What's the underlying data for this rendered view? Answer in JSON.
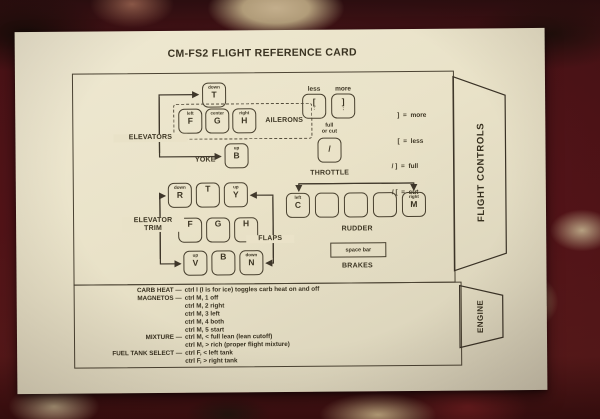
{
  "title": "CM-FS2 FLIGHT REFERENCE CARD",
  "flight_controls": {
    "tab_label": "FLIGHT CONTROLS",
    "yoke": {
      "label": "YOKE",
      "elevators_label": "ELEVATORS",
      "ailerons_label": "AILERONS",
      "key_down": {
        "hint": "down",
        "letter": "T"
      },
      "key_left": {
        "hint": "left",
        "letter": "F"
      },
      "key_center": {
        "hint": "center",
        "letter": "G"
      },
      "key_right": {
        "hint": "right",
        "letter": "H"
      },
      "key_up": {
        "hint": "up",
        "letter": "B"
      }
    },
    "trim": {
      "label_line1": "ELEVATOR",
      "label_line2": "TRIM",
      "flaps_label": "FLAPS",
      "keys": [
        {
          "hint": "down",
          "letter": "R"
        },
        {
          "hint": "",
          "letter": "T"
        },
        {
          "hint": "up",
          "letter": "Y"
        },
        {
          "hint": "",
          "letter": "F"
        },
        {
          "hint": "",
          "letter": "G"
        },
        {
          "hint": "",
          "letter": "H"
        },
        {
          "hint": "up",
          "letter": "V"
        },
        {
          "hint": "",
          "letter": "B"
        },
        {
          "hint": "down",
          "letter": "N"
        }
      ]
    },
    "throttle": {
      "label": "THROTTLE",
      "less_label": "less",
      "more_label": "more",
      "full_line1": "full",
      "full_line2": "or cut",
      "key_less": {
        "main": "[",
        "sub": ":"
      },
      "key_more": {
        "main": "]",
        "sub": ";"
      },
      "key_slash": {
        "main": "/",
        "sub": ""
      }
    },
    "legend": [
      "]  =  more",
      "[  =  less",
      "/ ]  =  full",
      "/ [  =  cut"
    ],
    "rudder": {
      "label": "RUDDER",
      "key_left": {
        "hint": "left",
        "letter": "C"
      },
      "key_right": {
        "hint": "right",
        "letter": "M"
      }
    },
    "brakes": {
      "label": "BRAKES",
      "key_label": "space bar"
    }
  },
  "engine": {
    "tab_label": "ENGINE",
    "rows": [
      {
        "label": "CARB HEAT —",
        "text": "ctrl I (I is for ice) toggles carb heat on and off"
      },
      {
        "label": "MAGNETOS —",
        "text": "ctrl M, 1 off"
      },
      {
        "label": "",
        "text": "ctrl M, 2 right"
      },
      {
        "label": "",
        "text": "ctrl M, 3 left"
      },
      {
        "label": "",
        "text": "ctrl M, 4 both"
      },
      {
        "label": "",
        "text": "ctrl M, 5 start"
      },
      {
        "label": "MIXTURE —",
        "text": "ctrl M, < full lean (lean cutoff)"
      },
      {
        "label": "",
        "text": "ctrl M, > rich (proper flight mixture)"
      },
      {
        "label": "FUEL TANK SELECT —",
        "text": "ctrl F, < left tank"
      },
      {
        "label": "",
        "text": "ctrl F, > right tank"
      }
    ]
  },
  "colors": {
    "card_paper": "#e9e2c8",
    "ink": "#37301f",
    "carpet_maroon": "#561419",
    "carpet_beige": "#c3ae8c"
  }
}
